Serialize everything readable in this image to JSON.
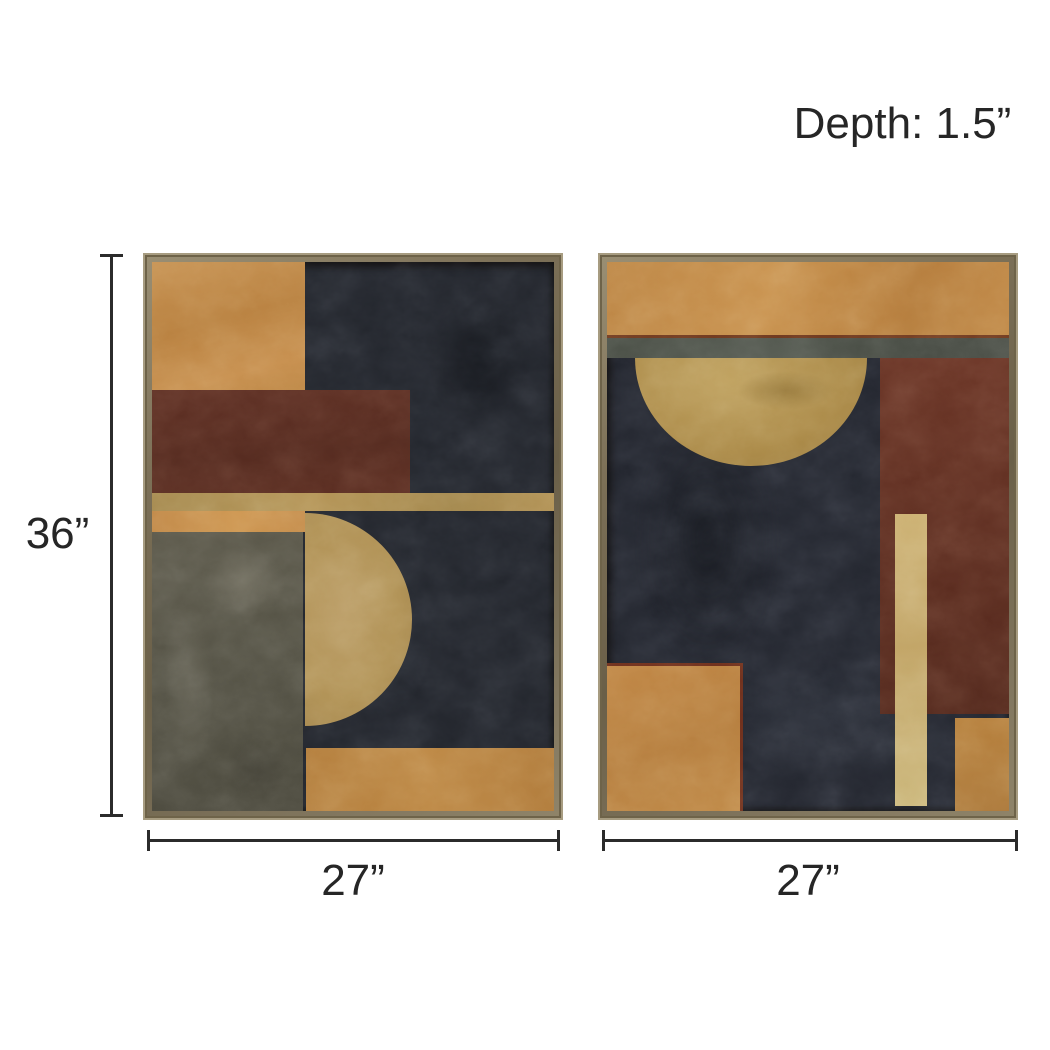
{
  "page": {
    "background_color": "#ffffff"
  },
  "product_diagram": {
    "depth_label": "Depth: 1.5”",
    "height_label": "36”",
    "panels": [
      {
        "name": "left-panel",
        "width_label": "27”"
      },
      {
        "name": "right-panel",
        "width_label": "27”"
      }
    ],
    "dimension_line_color": "#2b2b2b",
    "text_color": "#262626",
    "palette": {
      "frame_wood": "#7c7057",
      "frame_edge_light": "#a79c81",
      "canvas_navy": "#23262d",
      "ochre_orange": "#bf8a4b",
      "maroon": "#5c2d22",
      "gold_leaf": "#b09154",
      "light_gold_bar": "#c7ac6e",
      "olive_grey": "#565447",
      "grey_green_stripe": "#4e5349"
    }
  }
}
